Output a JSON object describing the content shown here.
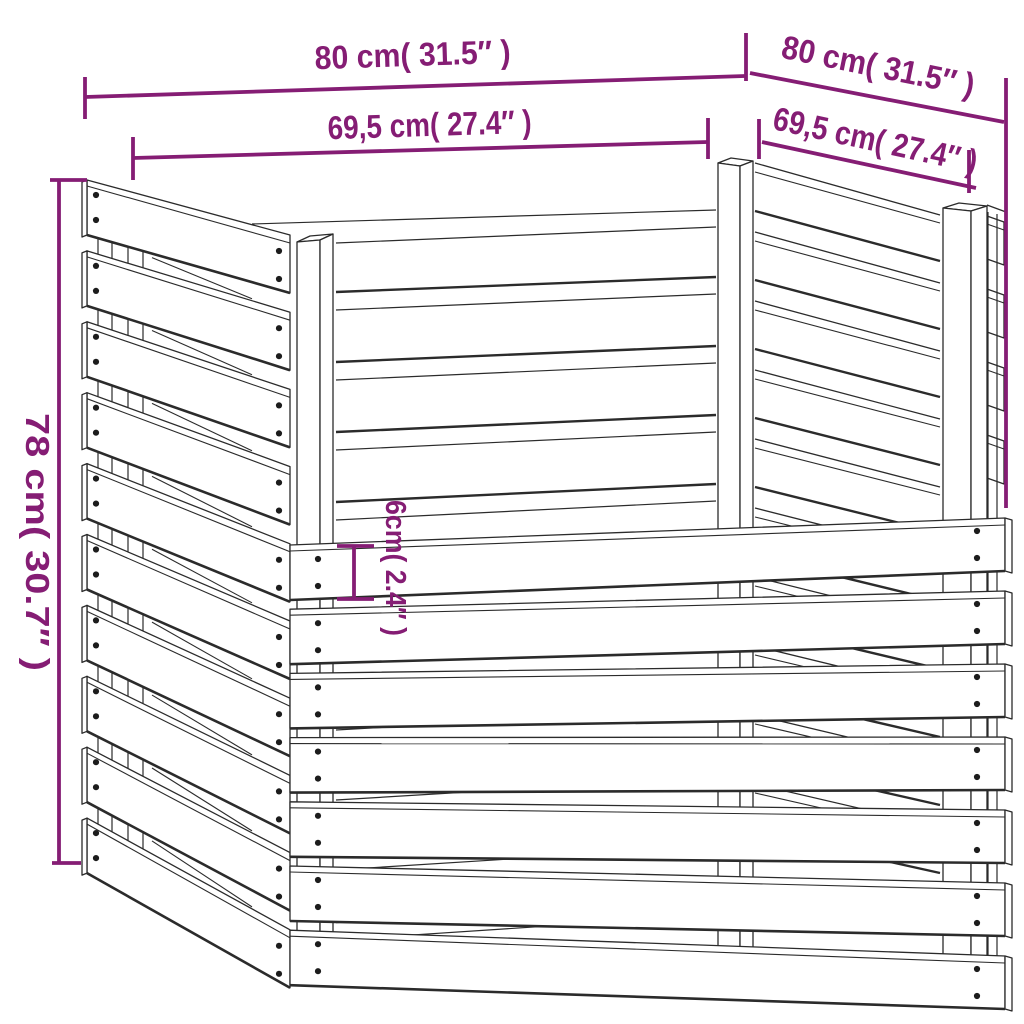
{
  "diagram": {
    "type": "product-dimension-diagram",
    "subject": "slatted wooden composter corner view",
    "dimensions": {
      "outer_width_left": {
        "label": "80 cm( 31.5″ )",
        "cm": 80,
        "inches": 31.5
      },
      "inner_width_left": {
        "label": "69,5 cm( 27.4″ )",
        "cm": 69.5,
        "inches": 27.4
      },
      "outer_width_right": {
        "label": "80 cm( 31.5″ )",
        "cm": 80,
        "inches": 31.5
      },
      "inner_width_right": {
        "label": "69,5 cm( 27.4″ )",
        "cm": 69.5,
        "inches": 27.4
      },
      "height": {
        "label": "78 cm( 30.7″ )",
        "cm": 78,
        "inches": 30.7
      },
      "board_width": {
        "label": "6cm( 2.4″ )",
        "cm": 6,
        "inches": 2.4
      }
    },
    "colors": {
      "dimension_accent": "#851d74",
      "line_art": "#2b2b2b",
      "screw_dot": "#1c1c1c",
      "background": "#ffffff"
    }
  }
}
